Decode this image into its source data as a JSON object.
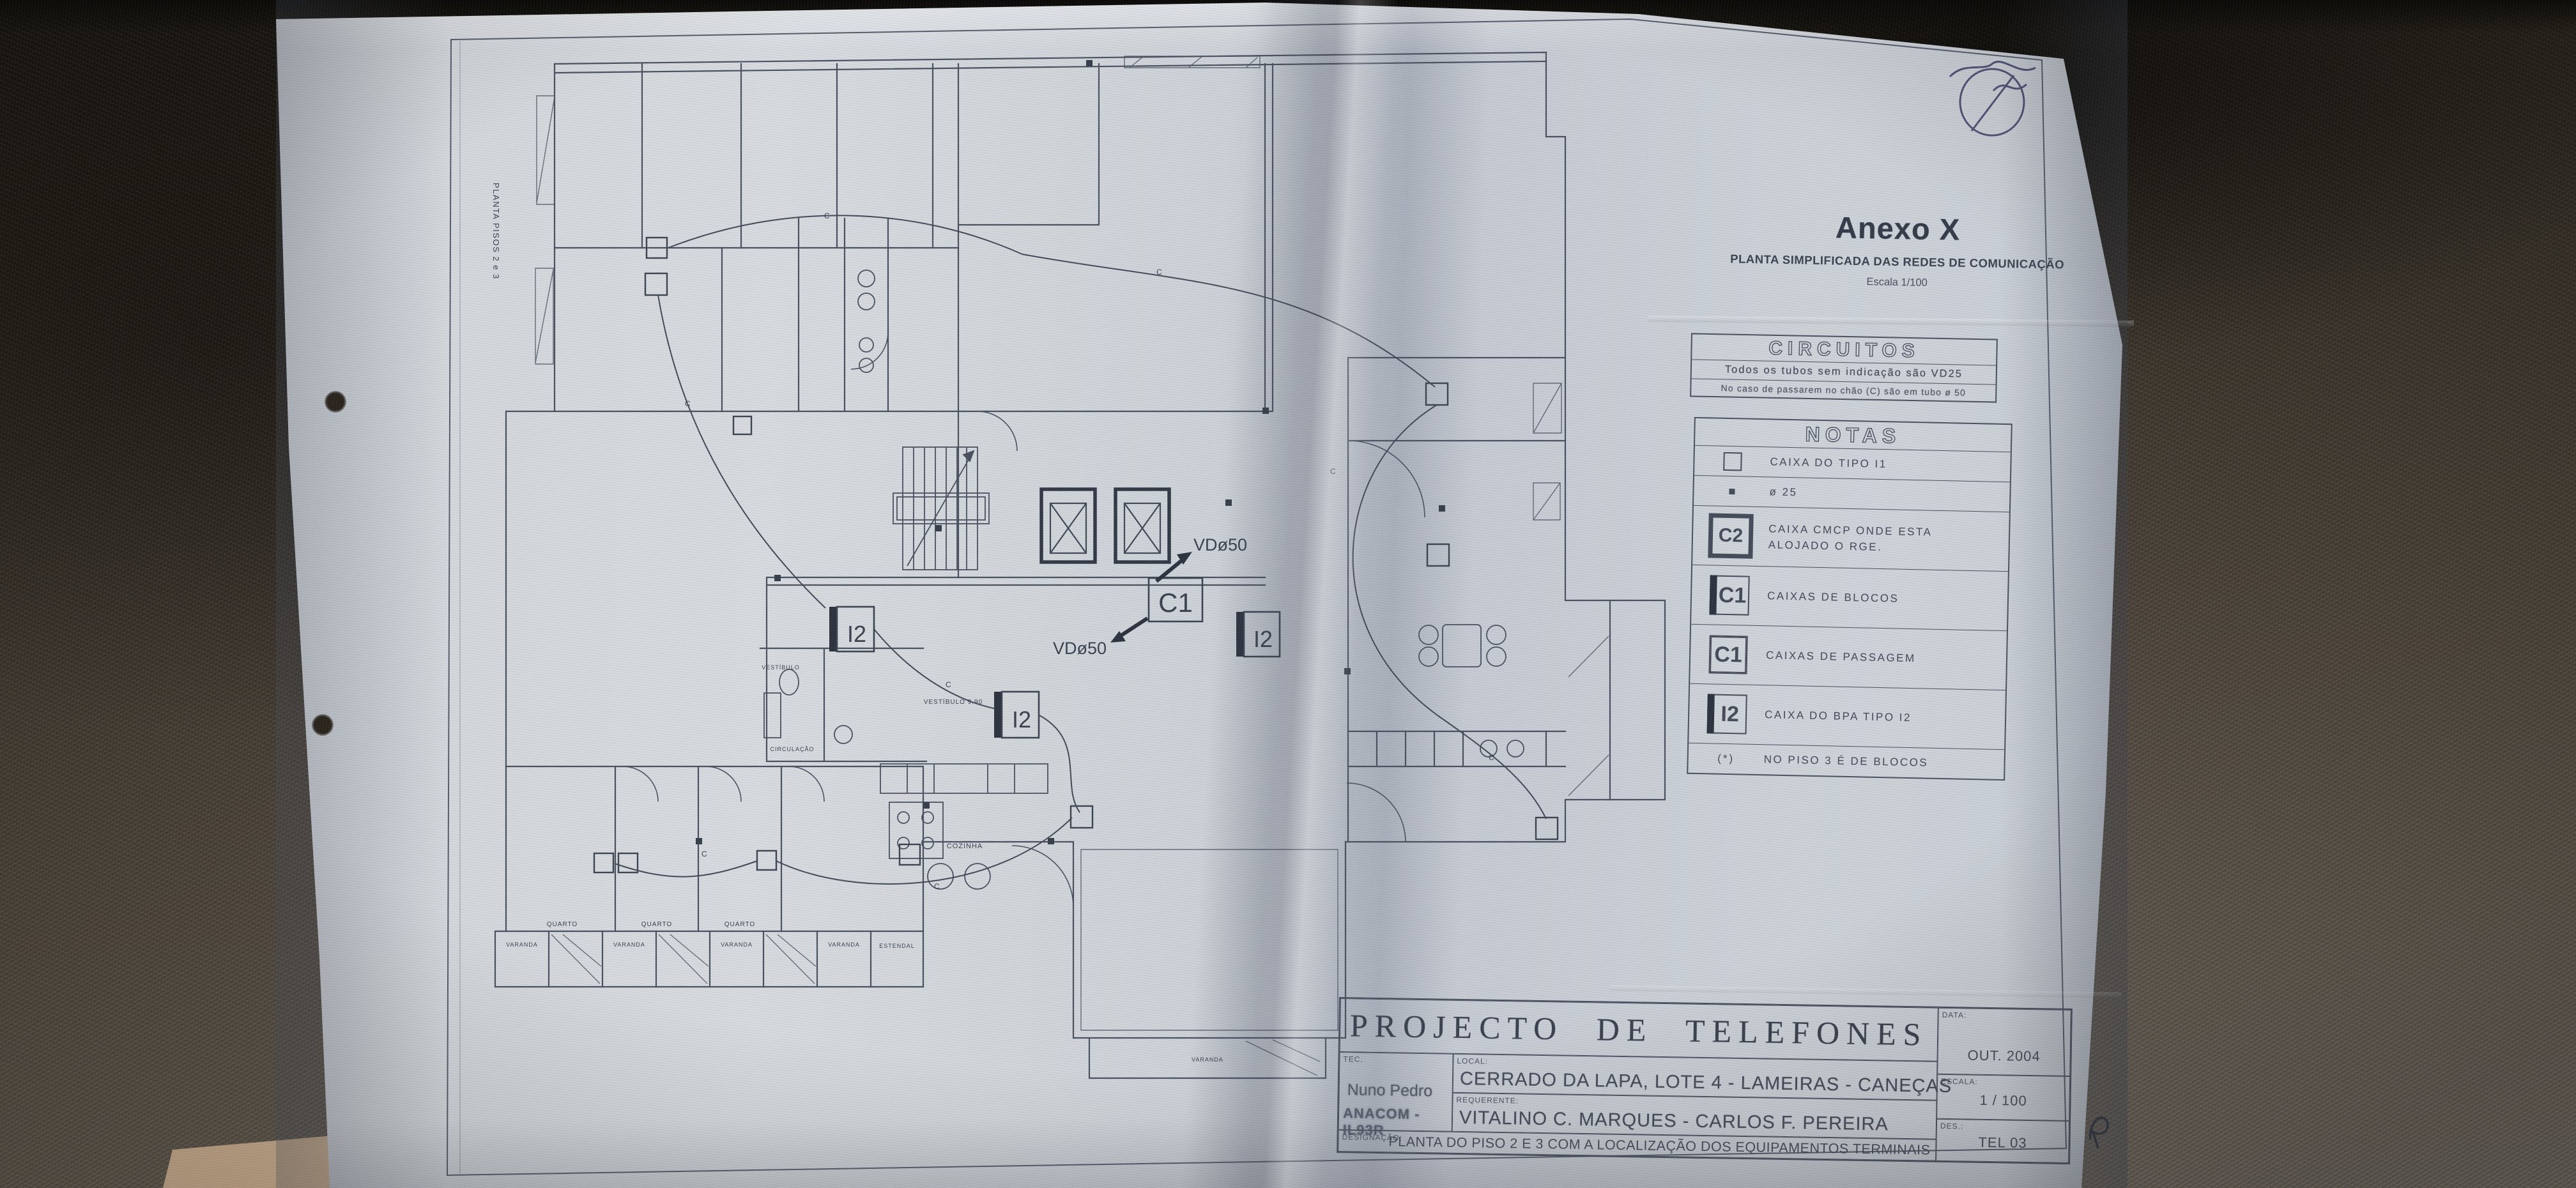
{
  "colors": {
    "paper": "#cfd3d9",
    "ink": "#424957",
    "leather_dark": "#272119",
    "leather_light": "#6f6860",
    "tan_surface": "#c9ab8c",
    "pen_blue": "#3c3f66"
  },
  "side_label": "PLANTA PISOS 2 e 3",
  "annex": {
    "title": "Anexo X",
    "subtitle": "PLANTA SIMPLIFICADA DAS REDES DE COMUNICAÇÃO",
    "scale": "Escala 1/100"
  },
  "circuitos": {
    "title": "CIRCUITOS",
    "line1": "Todos os tubos sem indicação são VD25",
    "line2": "No caso de passarem no chão (C) são em tubo ø 50"
  },
  "notas": {
    "title": "NOTAS",
    "rows": [
      {
        "symbol": "square-outline",
        "code": "",
        "text": "CAIXA DO TIPO I1"
      },
      {
        "symbol": "square-filled",
        "code": "",
        "text": "ø 25"
      },
      {
        "symbol": "box-heavy",
        "code": "C2",
        "text": "CAIXA CMCP ONDE ESTA ALOJADO O RGE."
      },
      {
        "symbol": "box-bar",
        "code": "C1",
        "text": "CAIXAS DE BLOCOS"
      },
      {
        "symbol": "box-double",
        "code": "C1",
        "text": "CAIXAS DE PASSAGEM"
      },
      {
        "symbol": "box-bar",
        "code": "I2",
        "text": "CAIXA DO BPA TIPO I2"
      },
      {
        "symbol": "note",
        "code": "(*)",
        "text": "NO PISO 3 É DE BLOCOS"
      }
    ]
  },
  "plan": {
    "labels": {
      "vd50": "VDø50",
      "c1": "C1",
      "i2": "I2",
      "circuit": "C"
    },
    "rooms": {
      "quarto": "QUARTO",
      "varanda": "VARANDA",
      "estendal": "ESTENDAL",
      "cozinha": "COZINHA",
      "vestibulo": "VESTÍBULO 9.90",
      "vestibulo2": "VESTÍBULO",
      "circulacao": "CIRCULAÇÃO"
    }
  },
  "title_block": {
    "title": "PROJECTO DE TELEFONES",
    "fields": {
      "data_label": "DATA:",
      "data": "OUT. 2004",
      "tec_label": "TEC.",
      "tec_name": "Nuno Pedro",
      "tec_id": "ANACOM - IL93R",
      "local_label": "LOCAL:",
      "local": "CERRADO DA LAPA, LOTE 4 - LAMEIRAS - CANEÇAS",
      "requerente_label": "REQUERENTE:",
      "requerente": "VITALINO C. MARQUES - CARLOS F. PEREIRA",
      "escala_label": "ESCALA:",
      "escala": "1 / 100",
      "des_label": "DES.:",
      "des": "TEL 03",
      "designacao_label": "DESIGNAÇÃO:",
      "designacao": "PLANTA DO PISO 2 E 3 COM A LOCALIZAÇÃO DOS EQUIPAMENTOS TERMINAIS"
    }
  }
}
